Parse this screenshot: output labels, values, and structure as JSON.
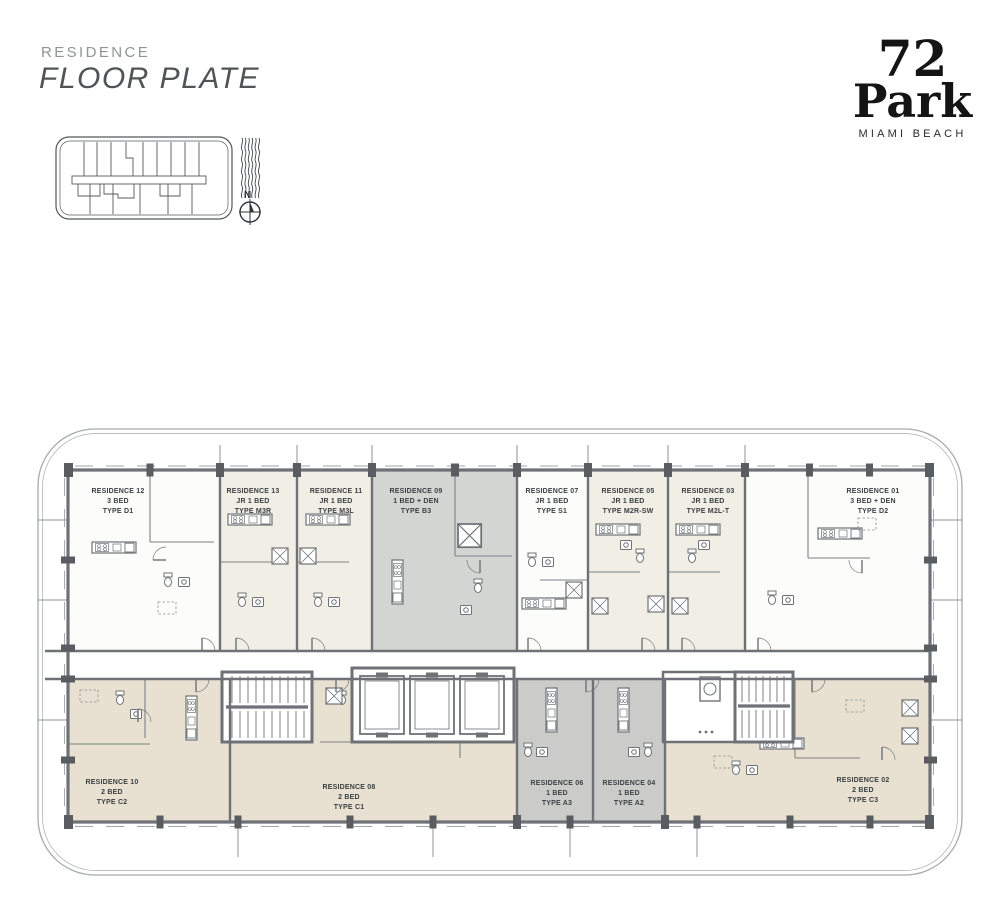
{
  "header": {
    "eyebrow": "RESIDENCE",
    "title": "FLOOR PLATE"
  },
  "logo": {
    "number": "72",
    "name": "Park",
    "subtitle": "MIAMI BEACH"
  },
  "compass": {
    "north_label": "N"
  },
  "floorplan": {
    "units": [
      {
        "id": "12",
        "name": "RESIDENCE 12",
        "beds": "3 BED",
        "type": "TYPE D1",
        "fill": "#fcfcfa"
      },
      {
        "id": "13",
        "name": "RESIDENCE 13",
        "beds": "JR 1 BED",
        "type": "TYPE M3R",
        "fill": "#f0eee5"
      },
      {
        "id": "11",
        "name": "RESIDENCE 11",
        "beds": "JR 1 BED",
        "type": "TYPE M3L",
        "fill": "#f0eee5"
      },
      {
        "id": "09",
        "name": "RESIDENCE 09",
        "beds": "1 BED + DEN",
        "type": "TYPE B3",
        "fill": "#d3d5d2"
      },
      {
        "id": "07",
        "name": "RESIDENCE 07",
        "beds": "JR 1 BED",
        "type": "TYPE S1",
        "fill": "#fcfcfa"
      },
      {
        "id": "05",
        "name": "RESIDENCE 05",
        "beds": "JR 1 BED",
        "type": "TYPE M2R-SW",
        "fill": "#f0eee5"
      },
      {
        "id": "03",
        "name": "RESIDENCE 03",
        "beds": "JR 1 BED",
        "type": "TYPE M2L-T",
        "fill": "#f0eee5"
      },
      {
        "id": "01",
        "name": "RESIDENCE 01",
        "beds": "3 BED + DEN",
        "type": "TYPE D2",
        "fill": "#fcfcfa"
      },
      {
        "id": "10",
        "name": "RESIDENCE 10",
        "beds": "2 BED",
        "type": "TYPE C2",
        "fill": "#e8e1d1"
      },
      {
        "id": "08",
        "name": "RESIDENCE 08",
        "beds": "2 BED",
        "type": "TYPE C1",
        "fill": "#e8e1d1"
      },
      {
        "id": "06",
        "name": "RESIDENCE 06",
        "beds": "1 BED",
        "type": "TYPE A3",
        "fill": "#cbccc9"
      },
      {
        "id": "04",
        "name": "RESIDENCE 04",
        "beds": "1 BED",
        "type": "TYPE A2",
        "fill": "#cbccc9"
      },
      {
        "id": "02",
        "name": "RESIDENCE 02",
        "beds": "2 BED",
        "type": "TYPE C3",
        "fill": "#e8e1d1"
      }
    ],
    "colors": {
      "wall": "#6e7276",
      "column": "#595d61",
      "boundary": "#a6abad",
      "cream": "#f0eee5",
      "beige": "#e8e1d1",
      "gray": "#d3d5d2",
      "gray_dark": "#cbccc9",
      "label_text": "#3b4043"
    }
  }
}
